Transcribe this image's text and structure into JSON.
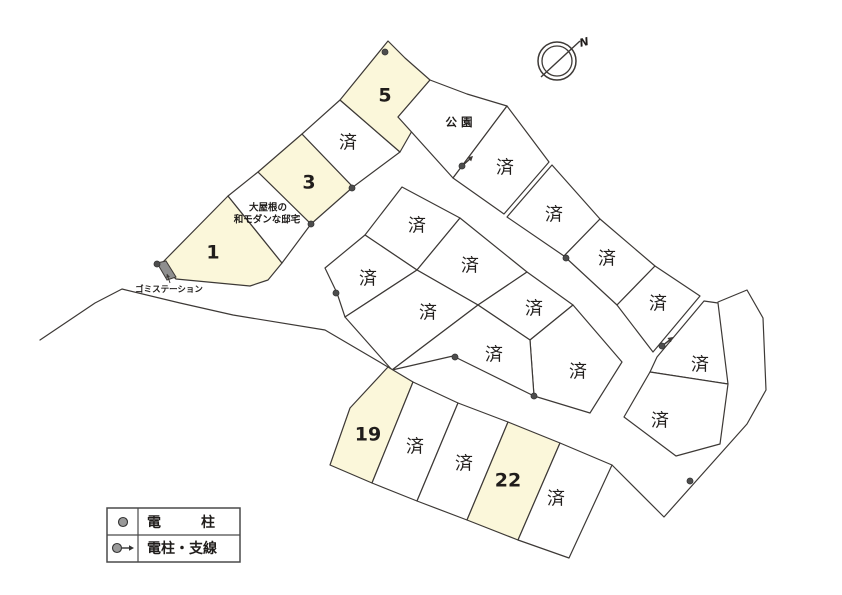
{
  "map": {
    "colors": {
      "background": "#ffffff",
      "line": "#3d3936",
      "available_fill": "#fbf7da",
      "sold_fill": "#ffffff",
      "park_fill": "#ffffff",
      "pole": "#4d4d4d",
      "station_fill": "#8f8f8f",
      "text": "#201d1b"
    },
    "lots": [
      {
        "id": "1",
        "label": "1",
        "status": "available",
        "points": [
          [
            163,
            262
          ],
          [
            228,
            196
          ],
          [
            282,
            263
          ],
          [
            268,
            280
          ],
          [
            250,
            286
          ],
          [
            176,
            279
          ],
          [
            161,
            265
          ]
        ],
        "label_pos": [
          213,
          252
        ]
      },
      {
        "id": "2",
        "label": "",
        "status": "sold",
        "points": [
          [
            228,
            196
          ],
          [
            258,
            172
          ],
          [
            311,
            224
          ],
          [
            282,
            263
          ]
        ],
        "label_pos": [
          268,
          212
        ],
        "annotation": [
          "大屋根の",
          "和モダンな邸宅"
        ],
        "annotation_pos": [
          [
            268,
            207
          ],
          [
            267,
            219
          ]
        ]
      },
      {
        "id": "3",
        "label": "3",
        "status": "available",
        "points": [
          [
            258,
            172
          ],
          [
            302,
            134
          ],
          [
            353,
            187
          ],
          [
            311,
            224
          ]
        ],
        "label_pos": [
          309,
          182
        ]
      },
      {
        "id": "4",
        "label": "済",
        "status": "sold",
        "points": [
          [
            302,
            134
          ],
          [
            340,
            100
          ],
          [
            400,
            152
          ],
          [
            353,
            187
          ]
        ],
        "label_pos": [
          348,
          142
        ]
      },
      {
        "id": "5",
        "label": "5",
        "status": "available",
        "points": [
          [
            340,
            100
          ],
          [
            388,
            41
          ],
          [
            405,
            58
          ],
          [
            430,
            80
          ],
          [
            398,
            117
          ],
          [
            412,
            131
          ],
          [
            400,
            152
          ]
        ],
        "label_pos": [
          385,
          95
        ]
      },
      {
        "id": "park",
        "label": "公園",
        "status": "park",
        "points": [
          [
            398,
            117
          ],
          [
            430,
            80
          ],
          [
            467,
            94
          ],
          [
            507,
            106
          ],
          [
            453,
            178
          ]
        ],
        "label_pos": [
          461,
          122
        ]
      },
      {
        "id": "b1",
        "label": "済",
        "status": "sold",
        "points": [
          [
            507,
            106
          ],
          [
            549,
            162
          ],
          [
            504,
            214
          ],
          [
            453,
            178
          ]
        ],
        "label_pos": [
          505,
          167
        ]
      },
      {
        "id": "b2",
        "label": "済",
        "status": "sold",
        "points": [
          [
            552,
            165
          ],
          [
            600,
            219
          ],
          [
            564,
            256
          ],
          [
            507,
            217
          ]
        ],
        "label_pos": [
          554,
          214
        ]
      },
      {
        "id": "b3",
        "label": "済",
        "status": "sold",
        "points": [
          [
            600,
            219
          ],
          [
            655,
            266
          ],
          [
            617,
            305
          ],
          [
            564,
            256
          ]
        ],
        "label_pos": [
          607,
          258
        ]
      },
      {
        "id": "b4",
        "label": "済",
        "status": "sold",
        "points": [
          [
            655,
            266
          ],
          [
            700,
            296
          ],
          [
            653,
            352
          ],
          [
            617,
            305
          ]
        ],
        "label_pos": [
          658,
          303
        ]
      },
      {
        "id": "c1",
        "label": "済",
        "status": "sold",
        "points": [
          [
            402,
            187
          ],
          [
            460,
            218
          ],
          [
            417,
            270
          ],
          [
            365,
            235
          ]
        ],
        "label_pos": [
          417,
          225
        ]
      },
      {
        "id": "c2",
        "label": "済",
        "status": "sold",
        "points": [
          [
            460,
            218
          ],
          [
            527,
            272
          ],
          [
            478,
            305
          ],
          [
            417,
            270
          ]
        ],
        "label_pos": [
          470,
          265
        ]
      },
      {
        "id": "c3",
        "label": "済",
        "status": "sold",
        "points": [
          [
            527,
            272
          ],
          [
            573,
            305
          ],
          [
            530,
            340
          ],
          [
            478,
            305
          ]
        ],
        "label_pos": [
          534,
          308
        ]
      },
      {
        "id": "c4",
        "label": "済",
        "status": "sold",
        "points": [
          [
            573,
            305
          ],
          [
            622,
            362
          ],
          [
            590,
            413
          ],
          [
            534,
            396
          ],
          [
            530,
            340
          ]
        ],
        "label_pos": [
          578,
          371
        ]
      },
      {
        "id": "c5",
        "label": "済",
        "status": "sold",
        "points": [
          [
            365,
            235
          ],
          [
            417,
            270
          ],
          [
            345,
            317
          ],
          [
            337,
            293
          ],
          [
            325,
            268
          ]
        ],
        "label_pos": [
          368,
          278
        ]
      },
      {
        "id": "c6",
        "label": "済",
        "status": "sold",
        "points": [
          [
            417,
            270
          ],
          [
            478,
            305
          ],
          [
            392,
            370
          ],
          [
            345,
            317
          ]
        ],
        "label_pos": [
          428,
          312
        ]
      },
      {
        "id": "c7",
        "label": "済",
        "status": "sold",
        "points": [
          [
            478,
            305
          ],
          [
            530,
            340
          ],
          [
            534,
            396
          ],
          [
            453,
            356
          ],
          [
            392,
            370
          ]
        ],
        "label_pos": [
          494,
          354
        ]
      },
      {
        "id": "19",
        "label": "19",
        "status": "available",
        "points": [
          [
            388,
            367
          ],
          [
            413,
            382
          ],
          [
            372,
            483
          ],
          [
            330,
            465
          ],
          [
            350,
            408
          ]
        ],
        "label_pos": [
          368,
          434
        ]
      },
      {
        "id": "ta",
        "label": "済",
        "status": "sold",
        "points": [
          [
            413,
            382
          ],
          [
            458,
            403
          ],
          [
            417,
            501
          ],
          [
            372,
            483
          ]
        ],
        "label_pos": [
          415,
          446
        ]
      },
      {
        "id": "tb",
        "label": "済",
        "status": "sold",
        "points": [
          [
            458,
            403
          ],
          [
            508,
            422
          ],
          [
            467,
            520
          ],
          [
            417,
            501
          ]
        ],
        "label_pos": [
          464,
          463
        ]
      },
      {
        "id": "22",
        "label": "22",
        "status": "available",
        "points": [
          [
            508,
            422
          ],
          [
            560,
            443
          ],
          [
            518,
            540
          ],
          [
            467,
            520
          ]
        ],
        "label_pos": [
          508,
          480
        ]
      },
      {
        "id": "tc",
        "label": "済",
        "status": "sold",
        "points": [
          [
            560,
            443
          ],
          [
            612,
            465
          ],
          [
            569,
            558
          ],
          [
            518,
            540
          ]
        ],
        "label_pos": [
          556,
          498
        ]
      },
      {
        "id": "r1",
        "label": "済",
        "status": "sold",
        "points": [
          [
            704,
            301
          ],
          [
            718,
            303
          ],
          [
            728,
            384
          ],
          [
            650,
            372
          ],
          [
            657,
            357
          ]
        ],
        "label_pos": [
          700,
          364
        ]
      },
      {
        "id": "r2",
        "label": "済",
        "status": "sold",
        "points": [
          [
            650,
            372
          ],
          [
            728,
            384
          ],
          [
            720,
            444
          ],
          [
            676,
            456
          ],
          [
            624,
            417
          ]
        ],
        "label_pos": [
          660,
          420
        ]
      }
    ],
    "roads": [
      {
        "name": "west-road-edge",
        "points": [
          [
            40,
            340
          ],
          [
            95,
            303
          ],
          [
            122,
            289
          ],
          [
            180,
            303
          ],
          [
            233,
            315
          ],
          [
            325,
            330
          ],
          [
            388,
            367
          ]
        ]
      },
      {
        "name": "east-outer-boundary",
        "points": [
          [
            718,
            302
          ],
          [
            747,
            290
          ],
          [
            763,
            318
          ],
          [
            766,
            390
          ],
          [
            747,
            424
          ],
          [
            664,
            517
          ],
          [
            612,
            465
          ]
        ]
      }
    ],
    "poles": [
      {
        "x": 157,
        "y": 264
      },
      {
        "x": 385,
        "y": 52
      },
      {
        "x": 311,
        "y": 224
      },
      {
        "x": 352,
        "y": 188
      },
      {
        "x": 566,
        "y": 258
      },
      {
        "x": 455,
        "y": 357
      },
      {
        "x": 534,
        "y": 396
      },
      {
        "x": 690,
        "y": 481
      },
      {
        "x": 336,
        "y": 293
      }
    ],
    "guy_poles": [
      {
        "x": 462,
        "y": 166,
        "dx": 11,
        "dy": -10
      },
      {
        "x": 662,
        "y": 346,
        "dx": 11,
        "dy": -9
      }
    ],
    "station": {
      "label": "ゴミステーション",
      "points": [
        [
          157,
          263
        ],
        [
          166,
          261
        ],
        [
          176,
          277
        ],
        [
          167,
          280
        ]
      ],
      "label_pos": [
        169,
        289
      ],
      "leader": [
        170,
        283,
        167,
        274
      ]
    },
    "compass": {
      "cx": 557,
      "cy": 61,
      "r_outer": 19,
      "r_inner": 15,
      "needle": [
        541,
        77,
        580,
        41
      ],
      "label": "N",
      "label_pos": [
        584,
        42
      ]
    },
    "legend": {
      "x": 107,
      "y": 508,
      "w": 133,
      "h": 54,
      "divider_x": 138,
      "rows": [
        {
          "symbol": "pole",
          "y": 522,
          "segments": [
            {
              "text": "電",
              "x": 147
            },
            {
              "text": "柱",
              "x": 201
            }
          ]
        },
        {
          "symbol": "pole-guy",
          "y": 548,
          "segments": [
            {
              "text": "電柱・支線",
              "x": 147
            }
          ]
        }
      ]
    }
  }
}
